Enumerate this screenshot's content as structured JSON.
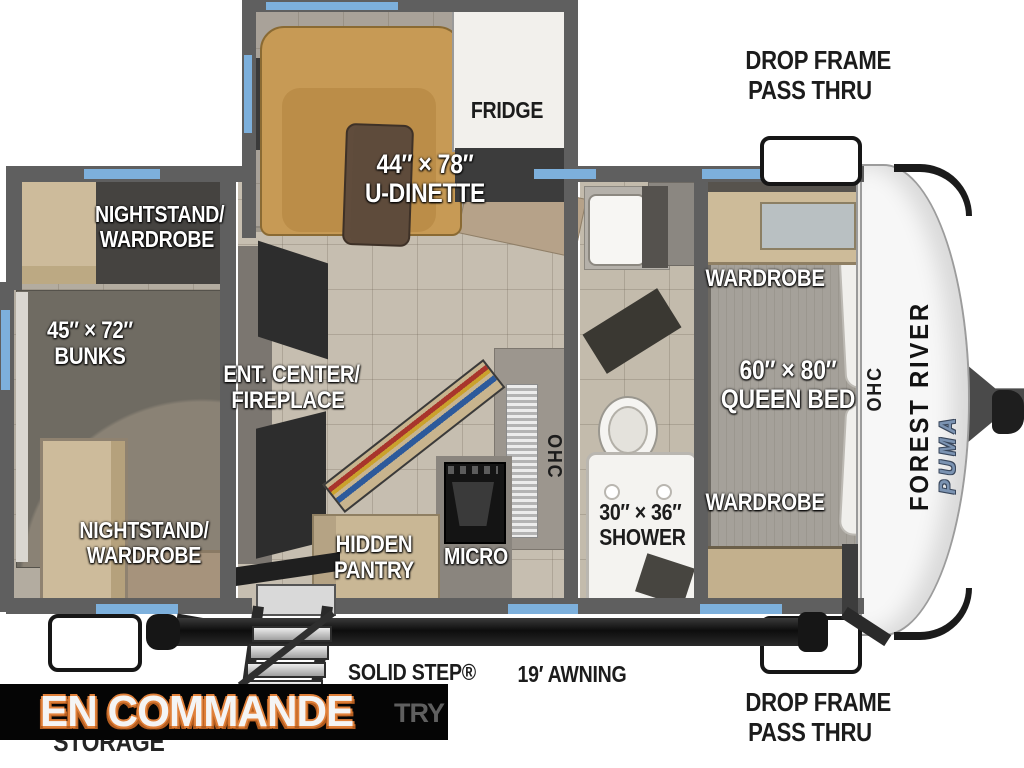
{
  "meta": {
    "type": "rv-floorplan-diagram",
    "orientation": "hitch-right"
  },
  "colors": {
    "wall": "#5f5f5f",
    "window_accent_blue": "#7db0dc",
    "floor_tile": "#c6beb0",
    "dinette_tan": "#c79a55",
    "wood_cabinet": "#cdbb9b",
    "label_white": "#ffffff",
    "label_black": "#1c1c1c",
    "banner_bg": "#050505",
    "banner_text": "#f4f4f4",
    "banner_outline_orange": "#e0803a",
    "brand_text": "#121212",
    "model_text_blue": "#7b93b2"
  },
  "plan": {
    "dinette": {
      "dims": "44″ × 78″",
      "name": "U-DINETTE"
    },
    "fridge": "FRIDGE",
    "rear_bedroom": {
      "nightstand_top_l1": "NIGHTSTAND/",
      "nightstand_top_l2": "WARDROBE",
      "bunks_dims": "45″ × 72″",
      "bunks_name": "BUNKS",
      "nightstand_bottom_l1": "NIGHTSTAND/",
      "nightstand_bottom_l2": "WARDROBE"
    },
    "living": {
      "ent_center_l1": "ENT. CENTER/",
      "ent_center_l2": "FIREPLACE",
      "pantry_l1": "HIDDEN",
      "pantry_l2": "PANTRY",
      "micro": "MICRO",
      "ohc": "OHC"
    },
    "bathroom": {
      "shower_dims": "30″ × 36″",
      "shower_name": "SHOWER"
    },
    "front_bedroom": {
      "wardrobe_top": "WARDROBE",
      "bed_dims": "60″ × 80″",
      "bed_name": "QUEEN BED",
      "wardrobe_bottom": "WARDROBE",
      "ohc": "OHC"
    }
  },
  "exterior": {
    "drop_frame_top_l1": "DROP FRAME",
    "drop_frame_top_l2": "PASS THRU",
    "drop_frame_bottom_l1": "DROP FRAME",
    "drop_frame_bottom_l2": "PASS THRU",
    "awning": "19′ AWNING",
    "solid_step": "SOLID STEP®",
    "brand": "FOREST RIVER",
    "model": "PUMA",
    "storage_partial": "STORAGE",
    "remnant_partial": "TRY"
  },
  "overlay": {
    "banner": "EN COMMANDE"
  }
}
